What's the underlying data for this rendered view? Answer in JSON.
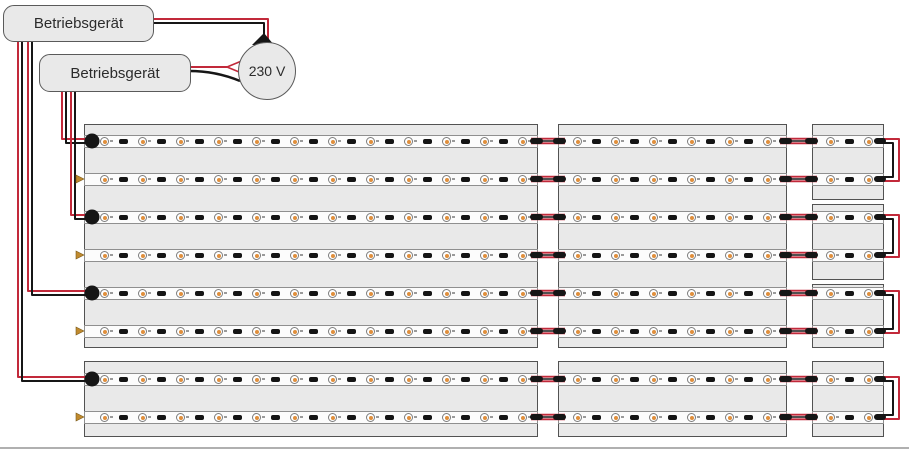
{
  "devices": [
    {
      "label": "Betriebsgerät"
    },
    {
      "label": "Betriebsgerät"
    }
  ],
  "power_source": {
    "label": "230 V"
  },
  "colors": {
    "wire_red": "#c2293a",
    "wire_black": "#161616",
    "panel_fill": "#e9e9e9",
    "panel_border": "#525252",
    "strip_fill": "#fcfcfc",
    "strip_border": "#8f8f8f",
    "led_ring": "#7d7d7d",
    "led_core": "#e08f3c",
    "resistor": "#141414",
    "box_fill": "#e9e9e9",
    "box_border": "#5a5a5a",
    "arrow": "#c08a2e",
    "text": "#2b2b2b"
  },
  "diagram": {
    "type": "led-wiring-diagram",
    "strip_rows": 8,
    "row_pairs": 4,
    "columns": [
      {
        "name": "long-led-module",
        "leds_per_strip": 12
      },
      {
        "name": "medium-led-module",
        "leds_per_strip": 6
      },
      {
        "name": "short-led-module",
        "leds_per_strip": 2
      }
    ],
    "connections": [
      {
        "from": "device-1",
        "to": "mains-230v"
      },
      {
        "from": "device-2",
        "to": "mains-230v"
      },
      {
        "from": "device-2",
        "to": "strip-row-1"
      },
      {
        "from": "device-2",
        "to": "strip-row-3"
      },
      {
        "from": "device-1",
        "to": "strip-row-5"
      },
      {
        "from": "device-1",
        "to": "strip-row-7"
      }
    ]
  }
}
